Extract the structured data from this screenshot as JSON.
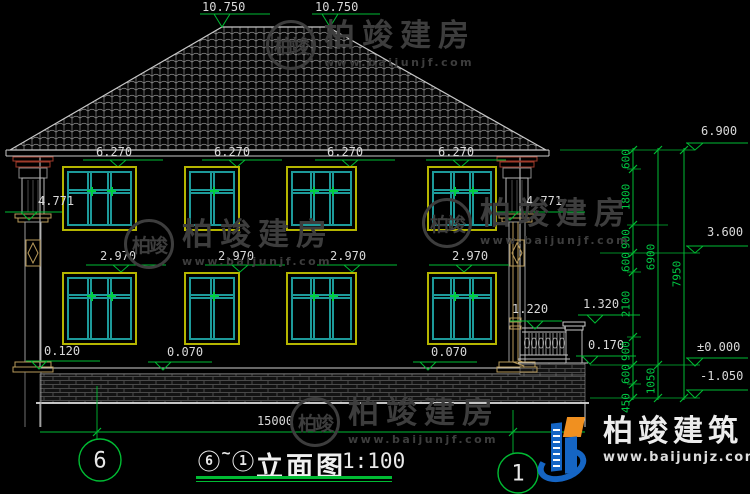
{
  "watermark": {
    "monogram": "柏竣",
    "text": "柏竣建房",
    "url": "www.baijunjf.com"
  },
  "logo": {
    "text": "柏竣建筑",
    "url": "www.baijunjz.com"
  },
  "title_block": {
    "axis_start": "6",
    "tilde": "~",
    "axis_end": "1",
    "name": "立面图",
    "scale": "1:100"
  },
  "grid_bubbles": {
    "left": "6",
    "right": "1"
  },
  "elevation_markers": {
    "ridge_left": "10.750",
    "ridge_right": "10.750",
    "upper_window_1": "6.270",
    "upper_window_2": "6.270",
    "upper_window_3": "6.270",
    "upper_window_4": "6.270",
    "lower_window_1": "2.970",
    "lower_window_2": "2.970",
    "lower_window_3": "2.970",
    "lower_window_4": "2.970",
    "capital_left": "4.771",
    "capital_right": "4.771",
    "floor_left": "0.120",
    "floor_mid": "0.070",
    "floor_right": "0.070",
    "porch_rail": "1.220",
    "porch_post": "1.320",
    "porch_floor": "0.170",
    "eave": "6.900",
    "storey": "3.600",
    "ground": "±0.000",
    "footing": "-1.050"
  },
  "dimension_chain": {
    "segments": [
      "600",
      "1800",
      "900",
      "600",
      "2100",
      "900",
      "600",
      "450"
    ],
    "upper_total": "6900",
    "plinth_total": "1050",
    "overall": "7950"
  },
  "width_dimension": "15000",
  "colors": {
    "dimension_green": "#00bb33",
    "window_frame_yellow": "#b5b500",
    "window_mullion_teal": "#1d9a9a",
    "capital_red": "#a03a2a",
    "trim_tan": "#b89a5a",
    "logo_blue": "#1565c4",
    "logo_orange": "#f09020"
  }
}
